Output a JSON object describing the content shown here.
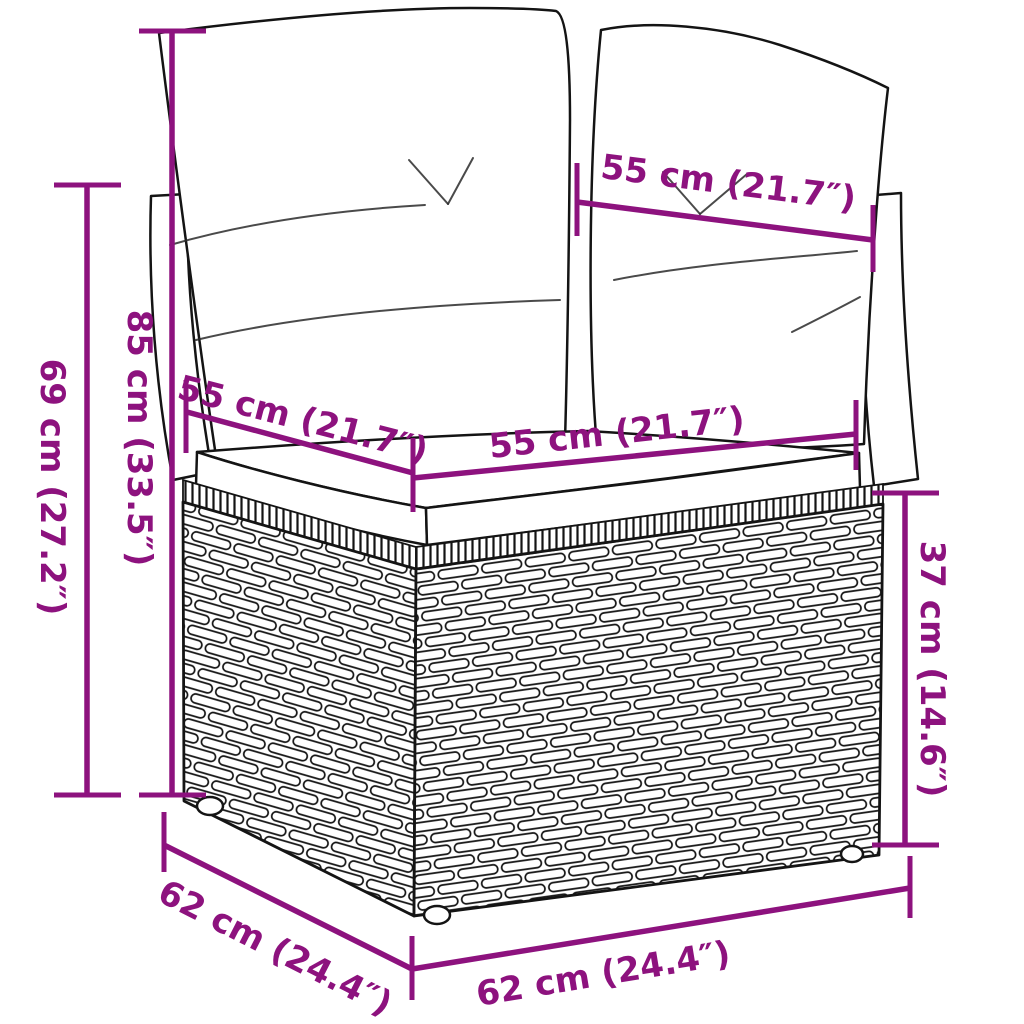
{
  "canvas": {
    "width": 1024,
    "height": 1024,
    "background": "#ffffff"
  },
  "diagram": {
    "subject": "rattan-corner-sofa-section-with-cushions",
    "accent_color": "#8D127E",
    "outline_color": "#141414",
    "dimensions": {
      "back_cushion_width": {
        "label": "55 cm (21.7″)"
      },
      "seat_depth_left": {
        "label": "55 cm (21.7″)"
      },
      "seat_width_front": {
        "label": "55 cm (21.7″)"
      },
      "height_with_cushion": {
        "label": "85 cm (33.5″)"
      },
      "height_backrest": {
        "label": "69 cm (27.2″)"
      },
      "base_height": {
        "label": "37 cm (14.6″)"
      },
      "base_depth": {
        "label": "62 cm (24.4″)"
      },
      "base_width": {
        "label": "62 cm (24.4″)"
      }
    }
  }
}
